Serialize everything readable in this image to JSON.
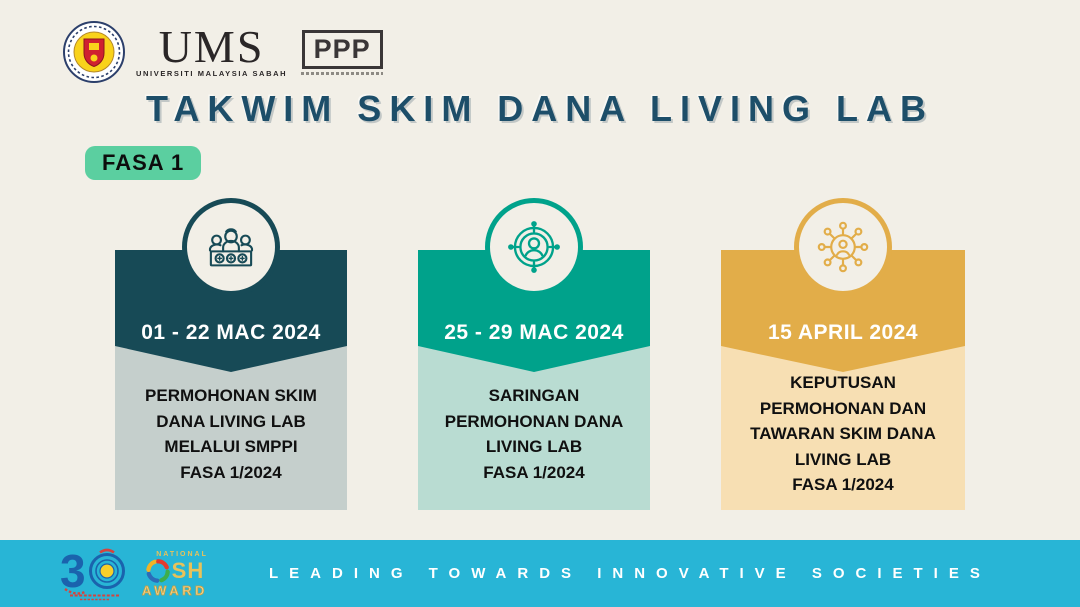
{
  "page": {
    "background_color": "#f2efe7",
    "accent_navy": "#1d4e69"
  },
  "header": {
    "ums_logo": {
      "crest_icon": "ums-crest",
      "wordmark": "UMS",
      "subtitle": "UNIVERSITI MALAYSIA SABAH"
    },
    "ppp": {
      "label": "PPP"
    }
  },
  "title": "TAKWIM SKIM DANA LIVING LAB",
  "phase_badge": {
    "label": "FASA 1",
    "color": "#5bcfa0"
  },
  "cards": [
    {
      "icon": "committee-people-icon",
      "date": "01 - 22 MAC 2024",
      "description": "PERMOHONAN SKIM\nDANA LIVING LAB\nMELALUI SMPPI\nFASA 1/2024",
      "header_color": "#174a56",
      "body_color": "#c5cfcc"
    },
    {
      "icon": "target-person-icon",
      "date": "25 - 29 MAC 2024",
      "description": "SARINGAN\nPERMOHONAN DANA\nLIVING LAB\nFASA 1/2024",
      "header_color": "#00a28b",
      "body_color": "#b9dcd2"
    },
    {
      "icon": "network-person-icon",
      "date": "15 APRIL 2024",
      "description": "KEPUTUSAN\nPERMOHONAN DAN\nTAWARAN SKIM DANA\nLIVING LAB\nFASA 1/2024",
      "header_color": "#e2ad49",
      "body_color": "#f7dfb3"
    }
  ],
  "footer": {
    "bar_color": "#28b5d6",
    "slogan": "LEADING TOWARDS INNOVATIVE SOCIETIES",
    "anniversary_logo": {
      "number": "30"
    },
    "osh_logo": {
      "top": "NATIONAL",
      "mid": "SH",
      "bottom": "AWARD"
    }
  }
}
